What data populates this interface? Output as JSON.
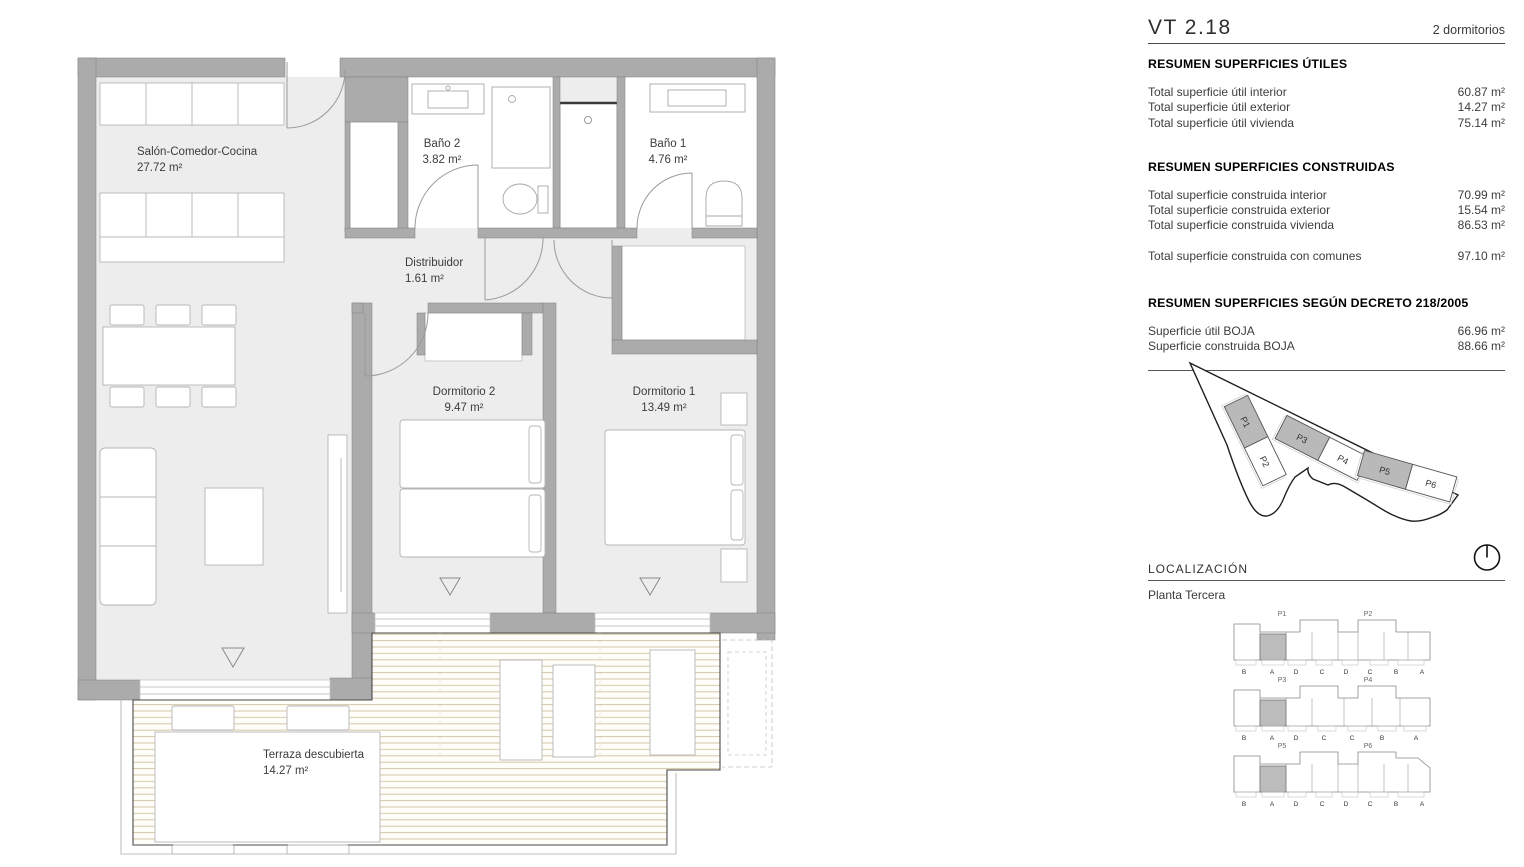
{
  "header": {
    "unit": "VT 2.18",
    "type": "2 dormitorios"
  },
  "sections": {
    "utiles": {
      "title": "RESUMEN SUPERFICIES ÚTILES",
      "rows": [
        {
          "label": "Total superficie útil interior",
          "value": "60.87 m²"
        },
        {
          "label": "Total superficie útil exterior",
          "value": "14.27 m²"
        },
        {
          "label": "Total superficie útil vivienda",
          "value": "75.14 m²"
        }
      ]
    },
    "construidas": {
      "title": "RESUMEN SUPERFICIES CONSTRUIDAS",
      "rows": [
        {
          "label": "Total superficie construida interior",
          "value": "70.99 m²"
        },
        {
          "label": "Total superficie construida exterior",
          "value": "15.54 m²"
        },
        {
          "label": "Total superficie construida vivienda",
          "value": "86.53 m²"
        }
      ],
      "total": {
        "label": "Total superficie construida con comunes",
        "value": "97.10 m²"
      }
    },
    "decreto": {
      "title": "RESUMEN SUPERFICIES SEGÚN DECRETO 218/2005",
      "rows": [
        {
          "label": "Superficie útil BOJA",
          "value": "66.96 m²"
        },
        {
          "label": "Superficie construida BOJA",
          "value": "88.66 m²"
        }
      ]
    }
  },
  "plan": {
    "rooms": {
      "salon": {
        "name": "Salón-Comedor-Cocina",
        "area": "27.72 m²"
      },
      "bano2": {
        "name": "Baño 2",
        "area": "3.82 m²"
      },
      "bano1": {
        "name": "Baño 1",
        "area": "4.76 m²"
      },
      "distribuidor": {
        "name": "Distribuidor",
        "area": "1.61 m²"
      },
      "dorm2": {
        "name": "Dormitorio 2",
        "area": "9.47 m²"
      },
      "dorm1": {
        "name": "Dormitorio 1",
        "area": "13.49 m²"
      },
      "terraza": {
        "name": "Terraza descubierta",
        "area": "14.27 m²"
      }
    }
  },
  "site_plan": {
    "plots": [
      {
        "label": "P1",
        "highlighted": true
      },
      {
        "label": "P2",
        "highlighted": false
      },
      {
        "label": "P3",
        "highlighted": true
      },
      {
        "label": "P4",
        "highlighted": false
      },
      {
        "label": "P5",
        "highlighted": true
      },
      {
        "label": "P6",
        "highlighted": false
      }
    ]
  },
  "localizacion": {
    "title": "LOCALIZACIÓN",
    "floor": "Planta Tercera",
    "rows": [
      {
        "left": "P1",
        "right": "P2",
        "highlighted_unit": "A",
        "letters": [
          "B",
          "A",
          "D",
          "C",
          "D",
          "C",
          "B",
          "A"
        ]
      },
      {
        "left": "P3",
        "right": "P4",
        "highlighted_unit": "A",
        "letters": [
          "B",
          "A",
          "D",
          "C",
          "C",
          "B",
          "A"
        ]
      },
      {
        "left": "P5",
        "right": "P6",
        "highlighted_unit": "A",
        "letters": [
          "B",
          "A",
          "D",
          "C",
          "D",
          "C",
          "B",
          "A"
        ]
      }
    ]
  },
  "colors": {
    "wall": "#ababab",
    "floor": "#ededed",
    "deck_stripe": "#d8cbae",
    "highlight": "#b9b9b9",
    "text": "#3d3d3d"
  }
}
